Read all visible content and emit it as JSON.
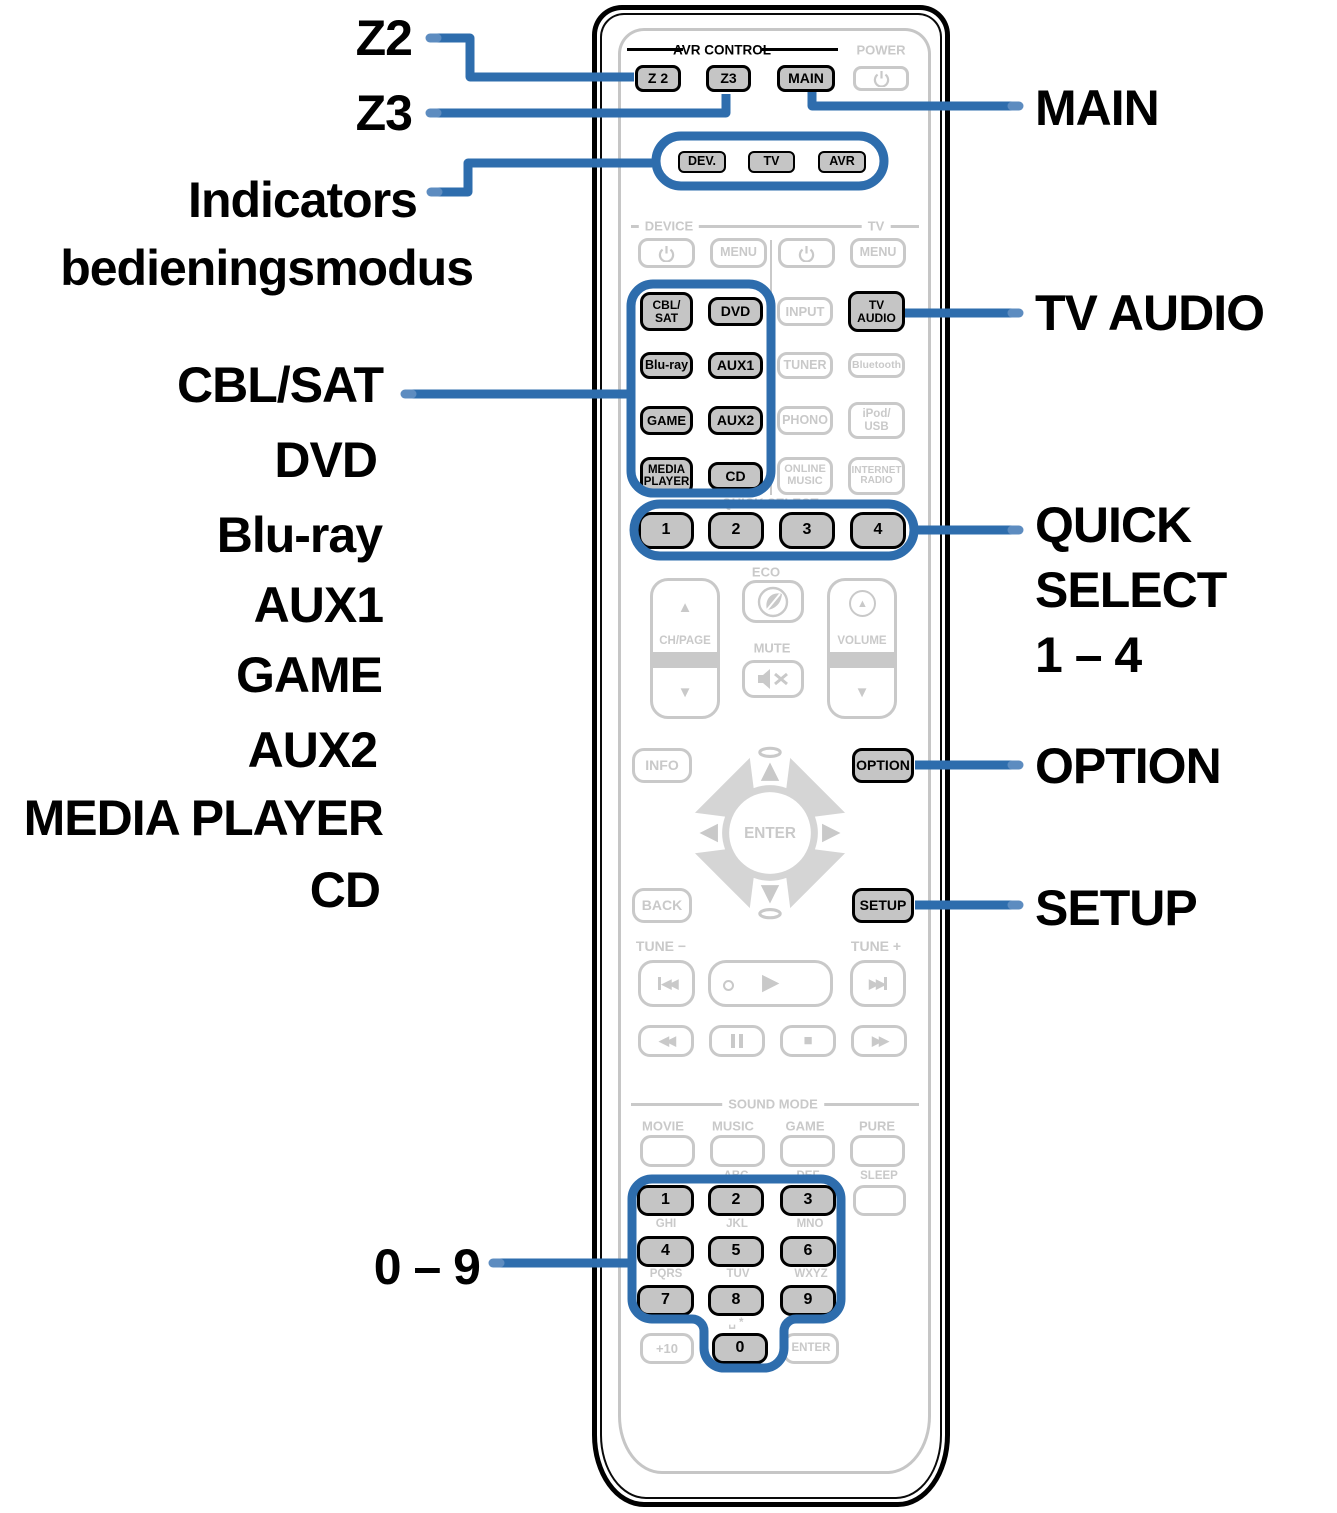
{
  "colors": {
    "accent_blue": "#2e6dad",
    "accent_blue_light": "#5d8cc0",
    "button_gray": "#c5c5c5",
    "disabled_gray": "#c9c9c9",
    "black": "#000000"
  },
  "callouts_left": {
    "z2": "Z2",
    "z3": "Z3",
    "indicators_line1": "Indicators",
    "indicators_line2": "bedieningsmodus",
    "cbl_sat": "CBL/SAT",
    "dvd": "DVD",
    "blu_ray": "Blu-ray",
    "aux1": "AUX1",
    "game": "GAME",
    "aux2": "AUX2",
    "media_player": "MEDIA PLAYER",
    "cd": "CD",
    "digits": "0 – 9"
  },
  "callouts_right": {
    "main": "MAIN",
    "tv_audio": "TV AUDIO",
    "quick_line1": "QUICK",
    "quick_line2": "SELECT",
    "quick_line3": "1 – 4",
    "option": "OPTION",
    "setup": "SETUP"
  },
  "remote": {
    "avr_control": {
      "title": "AVR CONTROL",
      "z2": "Z 2",
      "z3": "Z3",
      "main": "MAIN",
      "power": "POWER"
    },
    "indicators": {
      "dev": "DEV.",
      "tv": "TV",
      "avr": "AVR"
    },
    "device": {
      "label": "DEVICE",
      "menu": "MENU"
    },
    "tv": {
      "label": "TV",
      "menu": "MENU"
    },
    "inputs": {
      "cbl_sat": "CBL/\nSAT",
      "dvd": "DVD",
      "input": "INPUT",
      "tv_audio": "TV\nAUDIO",
      "blu_ray": "Blu-ray",
      "aux1": "AUX1",
      "tuner": "TUNER",
      "bluetooth": "Bluetooth",
      "game": "GAME",
      "aux2": "AUX2",
      "phono": "PHONO",
      "ipod_usb": "iPod/\nUSB",
      "media_player": "MEDIA\nPLAYER",
      "cd": "CD",
      "online_music": "ONLINE\nMUSIC",
      "internet_radio": "INTERNET\nRADIO"
    },
    "quick_select": {
      "label": "QUICK SELECT",
      "b1": "1",
      "b2": "2",
      "b3": "3",
      "b4": "4"
    },
    "center": {
      "eco": "ECO",
      "ch_page": "CH/PAGE",
      "mute": "MUTE",
      "volume": "VOLUME"
    },
    "nav": {
      "info": "INFO",
      "option": "OPTION",
      "back": "BACK",
      "setup": "SETUP",
      "enter": "ENTER",
      "tune_minus": "TUNE −",
      "tune_plus": "TUNE +"
    },
    "sound_mode": {
      "title": "SOUND MODE",
      "movie": "MOVIE",
      "music": "MUSIC",
      "game": "GAME",
      "pure": "PURE",
      "sleep": "SLEEP"
    },
    "numpad": {
      "d1": "1",
      "d2": "2",
      "d3": "3",
      "d4": "4",
      "d5": "5",
      "d6": "6",
      "d7": "7",
      "d8": "8",
      "d9": "9",
      "d0": "0",
      "plus10": "+10",
      "enter": "ENTER",
      "abc": "ABC",
      "def": "DEF",
      "ghi": "GHI",
      "jkl": "JKL",
      "mno": "MNO",
      "pqrs": "PQRS",
      "tuv": "TUV",
      "wxyz": "WXYZ",
      "space_star": "␣ *"
    },
    "icons": {
      "up": "▲",
      "down": "▼",
      "left": "◀",
      "right": "▶",
      "stop": "■",
      "rew": "◀◀",
      "ff": "▶▶",
      "play": "▶"
    }
  }
}
